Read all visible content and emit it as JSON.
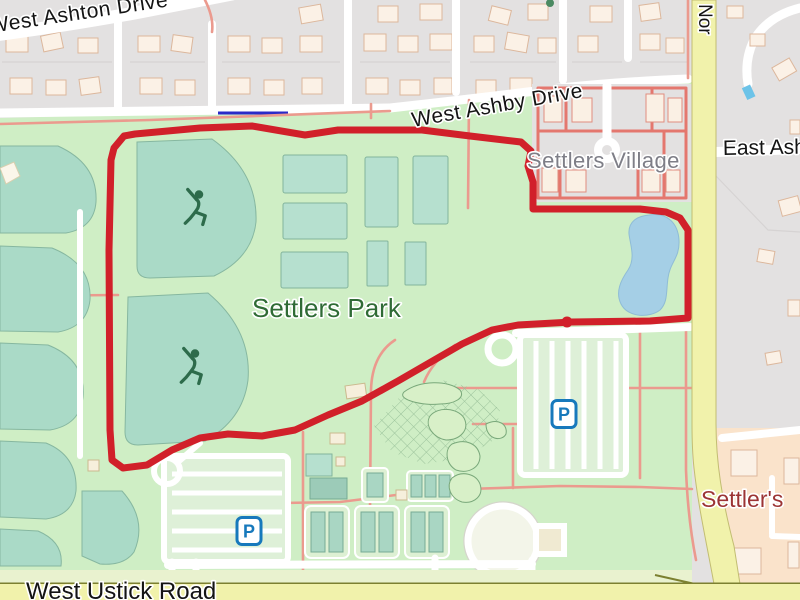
{
  "map": {
    "streets": {
      "ashton": "West Ashton Drive",
      "ashby": "West Ashby Drive",
      "north_partial": "Nor",
      "east_ash": "East Ash",
      "ustick": "West Ustick Road"
    },
    "places": {
      "village": "Settlers Village",
      "park": "Settlers Park",
      "poi_southeast": "Settler's"
    },
    "markers": {
      "parking_letter": "P",
      "parking_icon": "parking-icon",
      "baseball_icon": "baseball-player-icon",
      "waypoint_dot": "route-waypoint-dot"
    },
    "colors": {
      "route": "#d1202a",
      "park": "#cfeec5",
      "water": "#a5cfe6",
      "pitch": "#b6e0cf",
      "fan": "#aadac7",
      "residential": "#e3e1e1",
      "road_yellow": "#f1f2ab",
      "road_white": "#ffffff",
      "path": "#eb9a8e",
      "village_road": "#e4776e",
      "building": "#fbf1e6",
      "building_outline": "#dcb79c",
      "commercial": "#fae3cb",
      "parking_blue": "#1779bc",
      "park_label": "#2f6b35",
      "village_label": "#7e7e87",
      "poi_label": "#9c3434",
      "street_label": "#141414",
      "cycleway": "#2a2ac8"
    }
  }
}
